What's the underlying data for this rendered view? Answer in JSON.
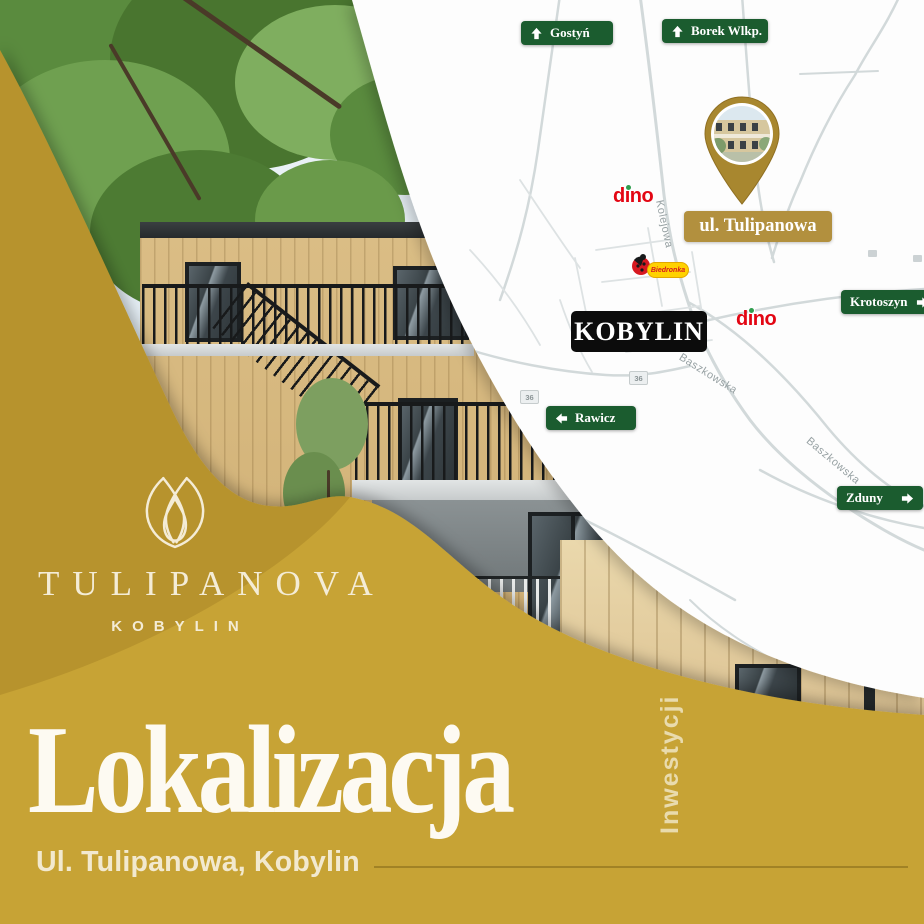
{
  "colors": {
    "gold_base": "#c7a336",
    "gold_dark": "#bb9129",
    "cream": "#f4ecd6",
    "sign_green": "#1b5c2f",
    "label_gold": "#b2903e",
    "black_label": "#0c0c0c",
    "dino_red": "#e30613",
    "dino_green": "#2f9e4e",
    "road": "#d2d9da",
    "road_minor": "#dde2e3",
    "map_bg": "#fdfdfd",
    "street": "#97a1a3",
    "pin_gold": "#a8872f"
  },
  "brand": {
    "name": "TULIPANOVA",
    "subtitle": "KOBYLIN"
  },
  "map": {
    "signs": [
      {
        "label": "Gostyń",
        "direction": "up"
      },
      {
        "label": "Borek Wlkp.",
        "direction": "up"
      },
      {
        "label": "Krotoszyn",
        "direction": "right"
      },
      {
        "label": "Zduny",
        "direction": "right"
      },
      {
        "label": "Rawicz",
        "direction": "left"
      }
    ],
    "location_label": "ul. Tulipanowa",
    "town_label": "KOBYLIN",
    "streets": [
      {
        "name": "Kolejowa"
      },
      {
        "name": "Baszkowska"
      },
      {
        "name": "Baszkowska"
      }
    ],
    "route_badges": [
      {
        "number": "36"
      },
      {
        "number": "36"
      }
    ],
    "stores": [
      {
        "name": "dino"
      },
      {
        "name": "dino"
      },
      {
        "name": "Biedronka"
      }
    ]
  },
  "footer": {
    "title": "Lokalizacja",
    "side_label": "Inwestycji",
    "address": "Ul. Tulipanowa, Kobylin"
  }
}
